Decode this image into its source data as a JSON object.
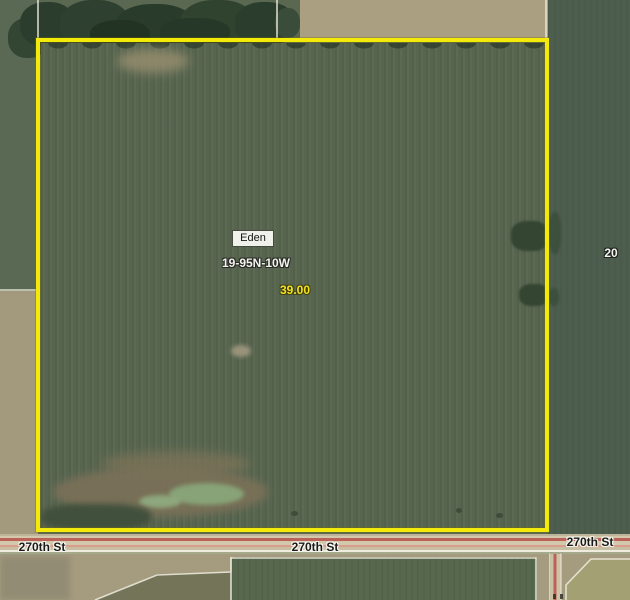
{
  "parcel": {
    "name": "Eden",
    "township": "19-95N-10W",
    "acres": "39.00"
  },
  "road_labels": {
    "west": "270th St",
    "center": "270th St",
    "east": "270th St"
  },
  "section_labels": {
    "east": "20"
  },
  "colors": {
    "parcel_outline_yellow": "#f3ea0b",
    "acres_text_yellow": "#f2e31f",
    "road_centerline_red": "#bb6157",
    "boundary_line_white": "#efecdd",
    "crop_field_green": "#57654f",
    "bare_field_tan": "#a59c7f"
  }
}
